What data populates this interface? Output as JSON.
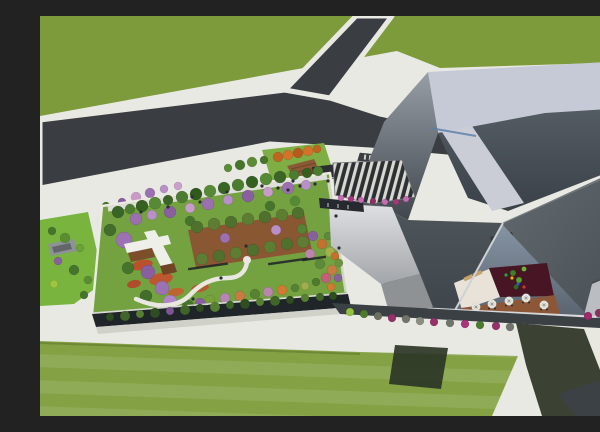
{
  "scene": {
    "title": "Aerial architectural rendering",
    "setting": "Oblique aerial 3D render of a cultural complex: angular gray museum volumes with a sunken courtyard terrace, a long green-roof building with rooftop garden and orchard, a louvered entrance canopy, asphalt access roads and mown lawns",
    "view": "aerial-oblique"
  },
  "palette": {
    "paving": "#e9e9e3",
    "road": "#3a3d41",
    "grass_north": "#7e9b3c",
    "grass_south": "#88a646",
    "lawn": "#74a241",
    "accent_strip": "#79b43e",
    "roof_band": "#c6cad6",
    "roof_inner": "#49525a",
    "skylight": "#cacdd5",
    "shard": "#4a5156",
    "shard_right": "#575e63",
    "light_face": "#c1c4c8",
    "courtyard_wall": "#76818f",
    "court_white": "#e8e2d9",
    "court_maroon": "#471523",
    "court_terrace": "#8b5737",
    "facade_dark": "#20252a",
    "walk_dark": "#3b4045",
    "canopy_dark": "#2c3033",
    "canopy_light": "#d8d8d2",
    "orchard_soil": "#8a5733",
    "pergola_white": "#efefe9",
    "deck_brown": "#7c4e2a",
    "flower_red": "#bf4a2c",
    "flower_magenta": "#a1286b",
    "blossom_purple": "#9b6fb0",
    "shadow_grass": "#2d3526",
    "shadow_road": "#3c4145",
    "path_white": "#e8e8e1"
  },
  "vegetation": {
    "garden_top_green_row": [
      [
        78,
        196,
        6,
        "#3a6527"
      ],
      [
        90,
        193,
        5,
        "#4c7c2f"
      ],
      [
        102,
        190,
        6,
        "#35601f"
      ],
      [
        115,
        187,
        6,
        "#568a34"
      ],
      [
        128,
        184,
        5,
        "#3a6527"
      ],
      [
        142,
        181,
        6,
        "#4c7c2f"
      ],
      [
        156,
        178,
        6,
        "#2f5a1e"
      ],
      [
        170,
        175,
        6,
        "#568a34"
      ],
      [
        184,
        172,
        6,
        "#3a6527"
      ],
      [
        198,
        169,
        6,
        "#4c7c2f"
      ],
      [
        212,
        166,
        6,
        "#35601f"
      ],
      [
        226,
        163,
        6,
        "#568a34"
      ],
      [
        240,
        161,
        6,
        "#3a6527"
      ],
      [
        254,
        159,
        5,
        "#4c7c2f"
      ],
      [
        267,
        157,
        5,
        "#35601f"
      ],
      [
        278,
        155,
        5,
        "#4c7c2f"
      ]
    ],
    "garden_purple_row": [
      [
        96,
        203,
        6,
        "#9b6fb0"
      ],
      [
        112,
        199,
        5,
        "#b98fc9"
      ],
      [
        130,
        196,
        6,
        "#8a5fa0"
      ],
      [
        150,
        192,
        5,
        "#c99bc9"
      ],
      [
        168,
        188,
        6,
        "#9b6fb0"
      ],
      [
        188,
        184,
        5,
        "#b98fc9"
      ],
      [
        208,
        180,
        6,
        "#8a5fa0"
      ],
      [
        228,
        176,
        5,
        "#c99bc9"
      ],
      [
        248,
        172,
        6,
        "#9b6fb0"
      ],
      [
        266,
        169,
        5,
        "#b98fc9"
      ],
      [
        150,
        205,
        5,
        "#47742c"
      ],
      [
        230,
        190,
        5,
        "#47742c"
      ],
      [
        255,
        185,
        5,
        "#568a34"
      ]
    ],
    "garden_left_cluster": [
      [
        70,
        214,
        6,
        "#426d2b"
      ],
      [
        84,
        224,
        8,
        "#9d72b4"
      ],
      [
        99,
        238,
        6,
        "#b286c6"
      ],
      [
        88,
        252,
        6,
        "#47742c"
      ],
      [
        108,
        256,
        7,
        "#8a5fa0"
      ],
      [
        122,
        272,
        7,
        "#9d72b4"
      ],
      [
        106,
        280,
        6,
        "#426d2b"
      ],
      [
        130,
        286,
        7,
        "#b286c6"
      ],
      [
        148,
        290,
        6,
        "#47742c"
      ],
      [
        160,
        287,
        5,
        "#8a5fa0"
      ]
    ],
    "orchard_trees": [
      [
        157,
        211,
        6,
        "#50702e"
      ],
      [
        174,
        208,
        6,
        "#5d7d33"
      ],
      [
        191,
        206,
        6,
        "#50702e"
      ],
      [
        208,
        203,
        6,
        "#5d7d33"
      ],
      [
        225,
        201,
        6,
        "#50702e"
      ],
      [
        242,
        199,
        6,
        "#5d7d33"
      ],
      [
        258,
        197,
        6,
        "#50702e"
      ],
      [
        162,
        243,
        6,
        "#5d7d33"
      ],
      [
        179,
        240,
        6,
        "#50702e"
      ],
      [
        196,
        237,
        6,
        "#5d7d33"
      ],
      [
        213,
        234,
        6,
        "#50702e"
      ],
      [
        230,
        231,
        6,
        "#5d7d33"
      ],
      [
        247,
        228,
        6,
        "#50702e"
      ],
      [
        263,
        226,
        6,
        "#5d7d33"
      ],
      [
        185,
        222,
        5,
        "#9b6fb0"
      ],
      [
        236,
        214,
        5,
        "#b98fc9"
      ]
    ],
    "garden_right_band": [
      [
        262,
        213,
        5,
        "#568233"
      ],
      [
        273,
        220,
        5,
        "#8a5f9e"
      ],
      [
        282,
        228,
        5,
        "#c4702e"
      ],
      [
        290,
        236,
        5,
        "#a3b04c"
      ],
      [
        270,
        238,
        5,
        "#bb86ad"
      ],
      [
        280,
        248,
        5,
        "#5d8a3a"
      ],
      [
        292,
        254,
        5,
        "#c97b44"
      ],
      [
        298,
        262,
        4,
        "#8a5f9e"
      ],
      [
        286,
        262,
        5,
        "#c2607a"
      ],
      [
        276,
        266,
        4,
        "#4e7a2e"
      ],
      [
        291,
        271,
        4,
        "#d07b2f"
      ],
      [
        299,
        247,
        4,
        "#6a9440"
      ],
      [
        295,
        240,
        4,
        "#c4702e"
      ],
      [
        288,
        220,
        4,
        "#5d8a3a"
      ]
    ],
    "garden_bottom_band": [
      [
        170,
        284,
        5,
        "#79a03d"
      ],
      [
        185,
        282,
        5,
        "#b586b6"
      ],
      [
        200,
        280,
        5,
        "#c97b44"
      ],
      [
        215,
        278,
        5,
        "#568233"
      ],
      [
        228,
        276,
        5,
        "#bb86ad"
      ],
      [
        242,
        274,
        5,
        "#d07b2f"
      ],
      [
        255,
        272,
        4,
        "#568233"
      ],
      [
        265,
        270,
        4,
        "#9fae4a"
      ]
    ],
    "facade_shrubs": [
      [
        70,
        301,
        4,
        "#2e4d20"
      ],
      [
        85,
        300,
        5,
        "#3f6628"
      ],
      [
        100,
        298,
        4,
        "#567f31"
      ],
      [
        115,
        297,
        5,
        "#2e4d20"
      ],
      [
        130,
        295,
        4,
        "#7c5694"
      ],
      [
        145,
        294,
        5,
        "#3f6628"
      ],
      [
        160,
        292,
        4,
        "#2e4d20"
      ],
      [
        175,
        291,
        5,
        "#567f31"
      ],
      [
        190,
        289,
        4,
        "#3f6628"
      ],
      [
        205,
        288,
        5,
        "#2e4d20"
      ],
      [
        220,
        286,
        4,
        "#567f31"
      ],
      [
        235,
        285,
        5,
        "#3f6628"
      ],
      [
        250,
        284,
        4,
        "#2e4d20"
      ],
      [
        265,
        282,
        4,
        "#567f31"
      ],
      [
        280,
        281,
        4,
        "#3f6628"
      ],
      [
        293,
        280,
        4,
        "#2e4d20"
      ]
    ],
    "west_strip_bushes": [
      [
        12,
        215,
        4,
        "#47742c"
      ],
      [
        25,
        222,
        5,
        "#5a8c33"
      ],
      [
        40,
        232,
        4,
        "#6ba238"
      ],
      [
        18,
        245,
        4,
        "#8a5f9e"
      ],
      [
        34,
        254,
        5,
        "#47742c"
      ],
      [
        48,
        264,
        4,
        "#5a8c33"
      ],
      [
        14,
        268,
        4,
        "#9fc43f"
      ],
      [
        44,
        279,
        4,
        "#47742c"
      ],
      [
        58,
        286,
        4,
        "#5a8c33"
      ]
    ],
    "dropoff_trees": [
      [
        238,
        141,
        5,
        "#c1641f"
      ],
      [
        248,
        139,
        5,
        "#d4722a"
      ],
      [
        258,
        137,
        5,
        "#b85a1c"
      ],
      [
        268,
        135,
        5,
        "#d4722a"
      ],
      [
        277,
        133,
        4,
        "#c1641f"
      ],
      [
        200,
        149,
        5,
        "#47742c"
      ],
      [
        212,
        146,
        5,
        "#5a8c33"
      ],
      [
        224,
        144,
        4,
        "#47742c"
      ],
      [
        188,
        152,
        4,
        "#5a8c33"
      ]
    ],
    "nw_flower_trees": [
      [
        96,
        181,
        5,
        "#c99bc9"
      ],
      [
        110,
        177,
        5,
        "#9b6fb0"
      ],
      [
        124,
        173,
        4,
        "#b98fc9"
      ],
      [
        82,
        186,
        4,
        "#8a5fa0"
      ],
      [
        138,
        170,
        4,
        "#c9a0cc"
      ],
      [
        66,
        190,
        4,
        "#47742c"
      ]
    ],
    "canopy_flowers": [
      [
        301,
        182,
        3,
        "#c66bb4"
      ],
      [
        311,
        183,
        3,
        "#a8357a"
      ],
      [
        321,
        184,
        3,
        "#c66bb4"
      ],
      [
        333,
        185,
        3,
        "#8e2f62"
      ],
      [
        345,
        186,
        3,
        "#c66bb4"
      ],
      [
        356,
        186,
        3,
        "#a8357a"
      ],
      [
        366,
        183,
        3,
        "#c66bb4"
      ]
    ],
    "basewalk_bushes": [
      [
        310,
        296,
        4,
        "#93c13f"
      ],
      [
        324,
        298,
        4,
        "#4e7a2e"
      ],
      [
        338,
        300,
        4,
        "#6b705f"
      ],
      [
        352,
        302,
        4,
        "#96306b"
      ],
      [
        366,
        303,
        4,
        "#70756a"
      ],
      [
        380,
        305,
        4,
        "#8a8f82"
      ],
      [
        394,
        306,
        4,
        "#96306b"
      ],
      [
        410,
        307,
        4,
        "#70756a"
      ],
      [
        425,
        308,
        4,
        "#a8357a"
      ],
      [
        440,
        309,
        4,
        "#4e7a2e"
      ],
      [
        456,
        310,
        4,
        "#96306b"
      ],
      [
        470,
        311,
        4,
        "#70756a"
      ]
    ],
    "magenta_row": [
      [
        548,
        300,
        4,
        "#a1286b"
      ],
      [
        559,
        297,
        4,
        "#8e2f62"
      ],
      [
        570,
        295,
        4,
        "#a1286b"
      ],
      [
        582,
        293,
        4,
        "#96306b"
      ],
      [
        594,
        291,
        4,
        "#a1286b"
      ],
      [
        599,
        287,
        3,
        "#8e2f62"
      ]
    ],
    "courtyard_plants": [
      [
        473,
        257,
        3,
        "#3f7d27"
      ],
      [
        479,
        264,
        3,
        "#57a12f"
      ],
      [
        476,
        271,
        2.5,
        "#2f6a1f"
      ],
      [
        484,
        253,
        2.5,
        "#6db33a"
      ]
    ]
  },
  "beds": [
    {
      "x": 102,
      "y": 249,
      "rx": 11,
      "ry": 5,
      "rot": -12,
      "color": "#bf4a2c"
    },
    {
      "x": 121,
      "y": 263,
      "rx": 12,
      "ry": 6,
      "rot": -12,
      "color": "#c2502e"
    },
    {
      "x": 94,
      "y": 268,
      "rx": 7,
      "ry": 4,
      "rot": -12,
      "color": "#b24527"
    },
    {
      "x": 136,
      "y": 276,
      "rx": 8,
      "ry": 4,
      "rot": -10,
      "color": "#c2602e"
    },
    {
      "x": 160,
      "y": 272,
      "rx": 9,
      "ry": 4,
      "rot": -10,
      "color": "#b9562f"
    }
  ],
  "benches": [
    [
      148,
      252,
      40
    ],
    [
      228,
      247,
      40
    ],
    [
      262,
      243,
      24
    ]
  ],
  "people": {
    "plaza": [
      [
        238,
        172
      ],
      [
        248,
        174
      ],
      [
        260,
        170
      ],
      [
        275,
        168
      ],
      [
        288,
        165
      ],
      [
        160,
        186
      ],
      [
        128,
        191
      ]
    ],
    "garden": [
      [
        152,
        181
      ],
      [
        187,
        176
      ],
      [
        222,
        170
      ],
      [
        253,
        165
      ],
      [
        206,
        230
      ],
      [
        181,
        262
      ],
      [
        153,
        283
      ],
      [
        101,
        196
      ],
      [
        296,
        200
      ],
      [
        299,
        232
      ]
    ],
    "courtyard": [
      [
        472,
        262,
        "#e0b400"
      ],
      [
        478,
        268,
        "#2b59c9"
      ],
      [
        484,
        271,
        "#c03b3b"
      ],
      [
        466,
        259,
        "#2e9e44"
      ]
    ]
  },
  "parasols": [
    [
      436,
      291
    ],
    [
      452,
      288
    ],
    [
      469,
      285
    ],
    [
      486,
      282
    ],
    [
      504,
      289
    ]
  ]
}
